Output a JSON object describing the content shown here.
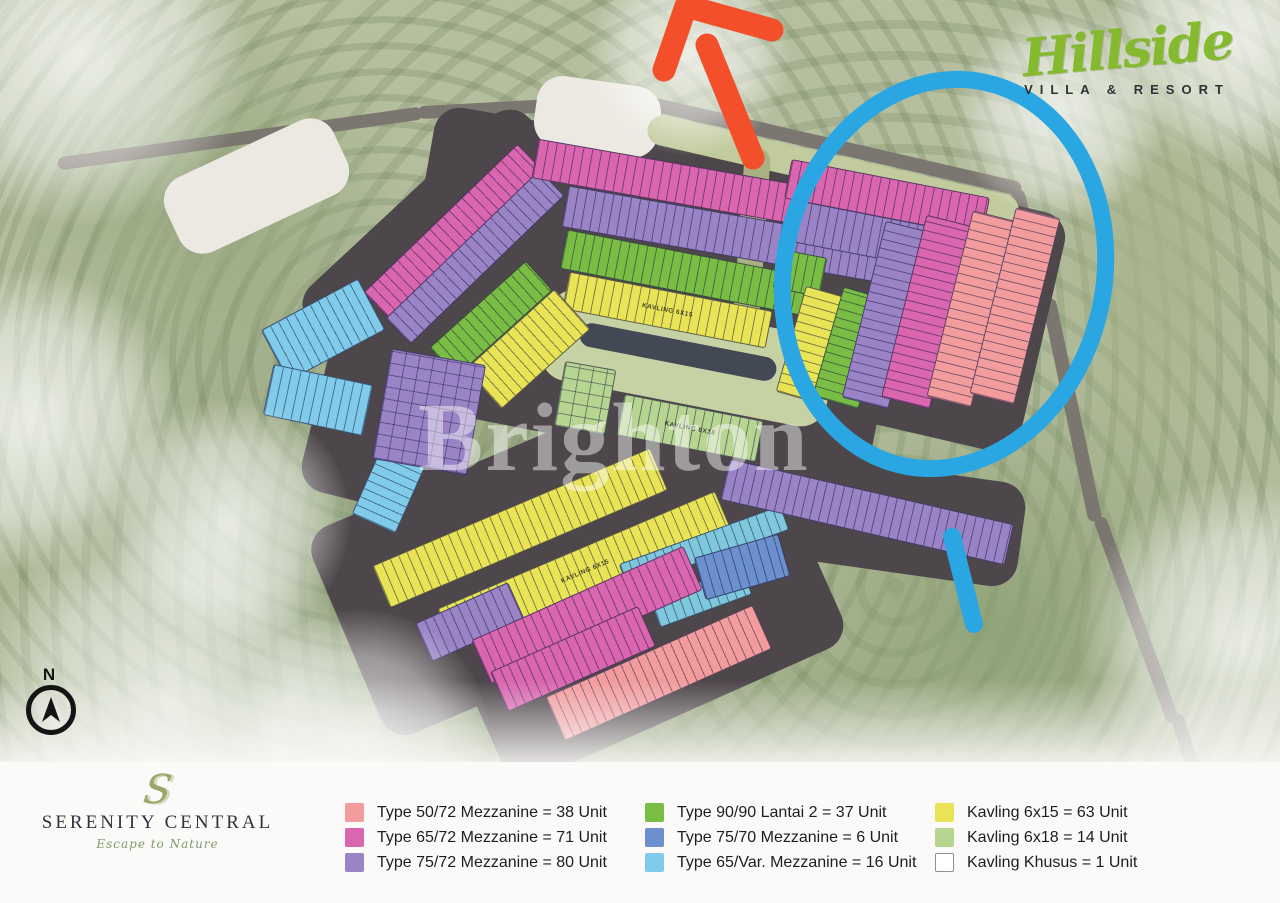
{
  "branding": {
    "hillside_title": "Hillside",
    "hillside_subtitle": "VILLA & RESORT",
    "serenity_monogram": "S",
    "serenity_title": "SERENITY CENTRAL",
    "serenity_tagline": "Escape to Nature"
  },
  "compass_label": "N",
  "watermark_text": "Brighton",
  "colors": {
    "types": {
      "type5072": "#f29c9e",
      "type6572": "#d966ae",
      "type7572": "#9a84c6",
      "type9090": "#79bd45",
      "type7570": "#6b90cd",
      "type65var": "#7fcbe9",
      "kavling615": "#e9e455",
      "kavling618": "#b6d591",
      "kavkhusus": "#ffffff",
      "water": "#7fc7dc"
    },
    "road": "#7b766f",
    "asphalt": "#4d464a",
    "plaza": "#ece9e2",
    "berm": "#c2cb9e",
    "park": "#c7d2a4",
    "clubhouse": "#424854",
    "median": "#a9b184",
    "annotation_blue": "#2aa7e2",
    "annotation_red": "#f24f2a"
  },
  "legend": {
    "columns": [
      {
        "items": [
          {
            "type": "type5072",
            "label": "Type 50/72 Mezzanine = 38 Unit"
          },
          {
            "type": "type6572",
            "label": "Type 65/72 Mezzanine = 71 Unit"
          },
          {
            "type": "type7572",
            "label": "Type 75/72 Mezzanine = 80 Unit"
          }
        ]
      },
      {
        "items": [
          {
            "type": "type9090",
            "label": "Type 90/90 Lantai 2 = 37 Unit"
          },
          {
            "type": "type7570",
            "label": "Type 75/70 Mezzanine = 6 Unit"
          },
          {
            "type": "type65var",
            "label": "Type 65/Var. Mezzanine = 16 Unit"
          }
        ]
      },
      {
        "items": [
          {
            "type": "kavling615",
            "label": "Kavling 6x15 = 63 Unit"
          },
          {
            "type": "kavling618",
            "label": "Kavling 6x18 = 14 Unit"
          },
          {
            "type": "kavkhusus",
            "label": "Kavling Khusus = 1 Unit",
            "outlined": true
          }
        ]
      }
    ]
  },
  "map": {
    "block_labels": {
      "kav615": "KAVLING 6X15",
      "kav618": "KAVLING 6X18"
    },
    "roads": [
      {
        "cx": 240,
        "cy": 138,
        "w": 368,
        "h": 13,
        "rot": -8
      },
      {
        "cx": 535,
        "cy": 106,
        "w": 235,
        "h": 13,
        "rot": -3
      },
      {
        "cx": 833,
        "cy": 146,
        "w": 385,
        "h": 14,
        "rot": 13
      },
      {
        "cx": 1031,
        "cy": 247,
        "w": 14,
        "h": 118,
        "rot": -14
      },
      {
        "cx": 1072,
        "cy": 410,
        "w": 14,
        "h": 228,
        "rot": -12
      },
      {
        "cx": 1136,
        "cy": 620,
        "w": 13,
        "h": 218,
        "rot": -20
      },
      {
        "cx": 1206,
        "cy": 812,
        "w": 13,
        "h": 205,
        "rot": -17
      }
    ],
    "patches": [
      {
        "c": "asphalt",
        "cx": 700,
        "cy": 233,
        "w": 560,
        "h": 165,
        "rot": 10
      },
      {
        "c": "asphalt",
        "cx": 468,
        "cy": 272,
        "w": 300,
        "h": 195,
        "rot": -43
      },
      {
        "c": "asphalt",
        "cx": 545,
        "cy": 555,
        "w": 430,
        "h": 225,
        "rot": -23
      },
      {
        "c": "asphalt",
        "cx": 648,
        "cy": 636,
        "w": 370,
        "h": 170,
        "rot": -24
      },
      {
        "c": "asphalt",
        "cx": 918,
        "cy": 308,
        "w": 255,
        "h": 245,
        "rot": 13
      },
      {
        "c": "asphalt",
        "cx": 858,
        "cy": 514,
        "w": 330,
        "h": 105,
        "rot": 8
      },
      {
        "c": "asphalt",
        "cx": 392,
        "cy": 412,
        "w": 150,
        "h": 190,
        "rot": 14
      },
      {
        "c": "asphalt",
        "cx": 625,
        "cy": 382,
        "w": 510,
        "h": 130,
        "rot": 11
      },
      {
        "c": "plaza",
        "cx": 597,
        "cy": 117,
        "w": 125,
        "h": 72,
        "rot": 8
      },
      {
        "c": "plaza",
        "cx": 256,
        "cy": 186,
        "w": 185,
        "h": 82,
        "rot": -25
      },
      {
        "c": "berm",
        "cx": 833,
        "cy": 170,
        "w": 380,
        "h": 30,
        "rot": 13
      },
      {
        "c": "park",
        "cx": 688,
        "cy": 358,
        "w": 290,
        "h": 92,
        "rot": 11
      },
      {
        "c": "clubhouse",
        "cx": 678,
        "cy": 352,
        "w": 200,
        "h": 24,
        "rot": 11
      },
      {
        "c": "median",
        "cx": 752,
        "cy": 235,
        "w": 26,
        "h": 175,
        "rot": 4
      }
    ],
    "bands": [
      {
        "type": "type6572",
        "cx": 452,
        "cy": 230,
        "w": 212,
        "h": 34,
        "rot": -44
      },
      {
        "type": "type7572",
        "cx": 474,
        "cy": 256,
        "w": 212,
        "h": 34,
        "rot": -44
      },
      {
        "type": "type6572",
        "cx": 724,
        "cy": 191,
        "w": 385,
        "h": 38,
        "rot": 10
      },
      {
        "type": "type7572",
        "cx": 744,
        "cy": 237,
        "w": 365,
        "h": 40,
        "rot": 10
      },
      {
        "type": "type9090",
        "cx": 686,
        "cy": 272,
        "w": 250,
        "h": 38,
        "rot": 11
      },
      {
        "type": "kavling615",
        "cx": 666,
        "cy": 309,
        "w": 205,
        "h": 36,
        "rot": 11,
        "labelKey": "kav615"
      },
      {
        "type": "type9090",
        "cx": 490,
        "cy": 318,
        "w": 128,
        "h": 38,
        "rot": -42
      },
      {
        "type": "kavling615",
        "cx": 527,
        "cy": 348,
        "w": 118,
        "h": 52,
        "rot": -42
      },
      {
        "type": "type65var",
        "cx": 322,
        "cy": 329,
        "w": 108,
        "h": 56,
        "rot": -28
      },
      {
        "type": "type65var",
        "cx": 317,
        "cy": 399,
        "w": 100,
        "h": 50,
        "rot": 12
      },
      {
        "type": "type65var",
        "cx": 397,
        "cy": 468,
        "w": 46,
        "h": 118,
        "rot": 24,
        "dir": "v"
      },
      {
        "type": "type7572",
        "cx": 428,
        "cy": 411,
        "w": 94,
        "h": 110,
        "rot": 10,
        "dir": "grid"
      },
      {
        "type": "kavling618",
        "cx": 584,
        "cy": 397,
        "w": 50,
        "h": 64,
        "rot": 10,
        "dir": "grid"
      },
      {
        "type": "kavling618",
        "cx": 689,
        "cy": 427,
        "w": 140,
        "h": 40,
        "rot": 11,
        "labelKey": "kav618"
      },
      {
        "type": "kavling615",
        "cx": 519,
        "cy": 527,
        "w": 300,
        "h": 44,
        "rot": -23
      },
      {
        "type": "kavling615",
        "cx": 584,
        "cy": 570,
        "w": 300,
        "h": 44,
        "rot": -23,
        "labelKey": "kav615"
      },
      {
        "type": "water",
        "cx": 703,
        "cy": 546,
        "w": 170,
        "h": 24,
        "rot": -20
      },
      {
        "type": "water",
        "cx": 700,
        "cy": 596,
        "w": 96,
        "h": 28,
        "rot": -20
      },
      {
        "type": "type7572",
        "cx": 469,
        "cy": 621,
        "w": 100,
        "h": 40,
        "rot": -24
      },
      {
        "type": "type6572",
        "cx": 586,
        "cy": 614,
        "w": 230,
        "h": 46,
        "rot": -24
      },
      {
        "type": "type6572",
        "cx": 572,
        "cy": 658,
        "w": 160,
        "h": 42,
        "rot": -24
      },
      {
        "type": "type5072",
        "cx": 657,
        "cy": 672,
        "w": 225,
        "h": 46,
        "rot": -24
      },
      {
        "type": "type7572",
        "cx": 866,
        "cy": 511,
        "w": 290,
        "h": 40,
        "rot": 13
      },
      {
        "type": "type7570",
        "cx": 741,
        "cy": 566,
        "w": 86,
        "h": 42,
        "rot": -16
      },
      {
        "type": "type6572",
        "cx": 886,
        "cy": 197,
        "w": 200,
        "h": 38,
        "rot": 11
      },
      {
        "type": "type7572",
        "cx": 906,
        "cy": 242,
        "w": 220,
        "h": 40,
        "rot": 11
      },
      {
        "type": "type9090",
        "cx": 799,
        "cy": 272,
        "w": 46,
        "h": 38,
        "rot": 11
      },
      {
        "type": "kavling615",
        "cx": 812,
        "cy": 344,
        "w": 44,
        "h": 108,
        "rot": 16,
        "dir": "v"
      },
      {
        "type": "type9090",
        "cx": 850,
        "cy": 347,
        "w": 46,
        "h": 112,
        "rot": 16,
        "dir": "v"
      },
      {
        "type": "type7572",
        "cx": 886,
        "cy": 314,
        "w": 46,
        "h": 180,
        "rot": 14,
        "dir": "v"
      },
      {
        "type": "type6572",
        "cx": 927,
        "cy": 311,
        "w": 48,
        "h": 186,
        "rot": 14,
        "dir": "v"
      },
      {
        "type": "type5072",
        "cx": 971,
        "cy": 308,
        "w": 44,
        "h": 190,
        "rot": 14,
        "dir": "v"
      },
      {
        "type": "type5072",
        "cx": 1014,
        "cy": 305,
        "w": 44,
        "h": 190,
        "rot": 14,
        "dir": "v"
      }
    ],
    "fog": [
      {
        "cx": 80,
        "cy": 55,
        "r": 170
      },
      {
        "cx": 30,
        "cy": 420,
        "r": 150
      },
      {
        "cx": 170,
        "cy": 700,
        "r": 190
      },
      {
        "cx": 360,
        "cy": 740,
        "r": 130
      },
      {
        "cx": 1235,
        "cy": 35,
        "r": 130
      },
      {
        "cx": 1240,
        "cy": 640,
        "r": 160
      },
      {
        "cx": 1060,
        "cy": 115,
        "r": 105
      },
      {
        "cx": 690,
        "cy": 55,
        "r": 100
      },
      {
        "cx": 230,
        "cy": 520,
        "r": 120
      }
    ]
  }
}
